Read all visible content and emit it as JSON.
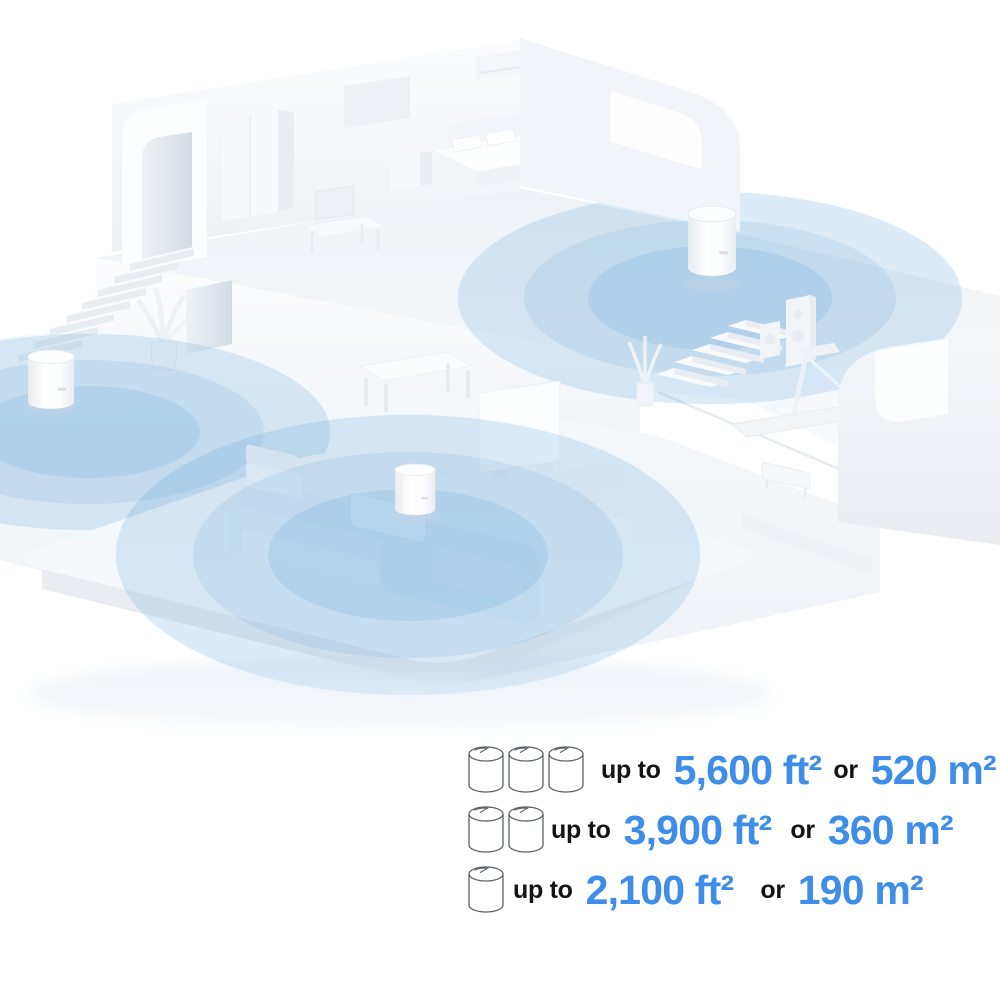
{
  "page": {
    "background": "#ffffff"
  },
  "colors": {
    "accent_text_blue": "#3E8DE8",
    "label_text": "#141414",
    "coverage_blue": "#5BA1D9",
    "icon_outline": "#5C6066"
  },
  "illustration": {
    "deco_unit_count": 3,
    "coverage_zone_count": 3
  },
  "legend": {
    "rows": [
      {
        "units": 3,
        "prefix": "up to",
        "ft_value": "5,600 ft²",
        "conj": "or",
        "m_value": "520 m²"
      },
      {
        "units": 2,
        "prefix": "up to",
        "ft_value": "3,900 ft²",
        "conj": "or",
        "m_value": "360 m²"
      },
      {
        "units": 1,
        "prefix": "up to",
        "ft_value": "2,100 ft²",
        "conj": "or",
        "m_value": "190 m²"
      }
    ]
  }
}
